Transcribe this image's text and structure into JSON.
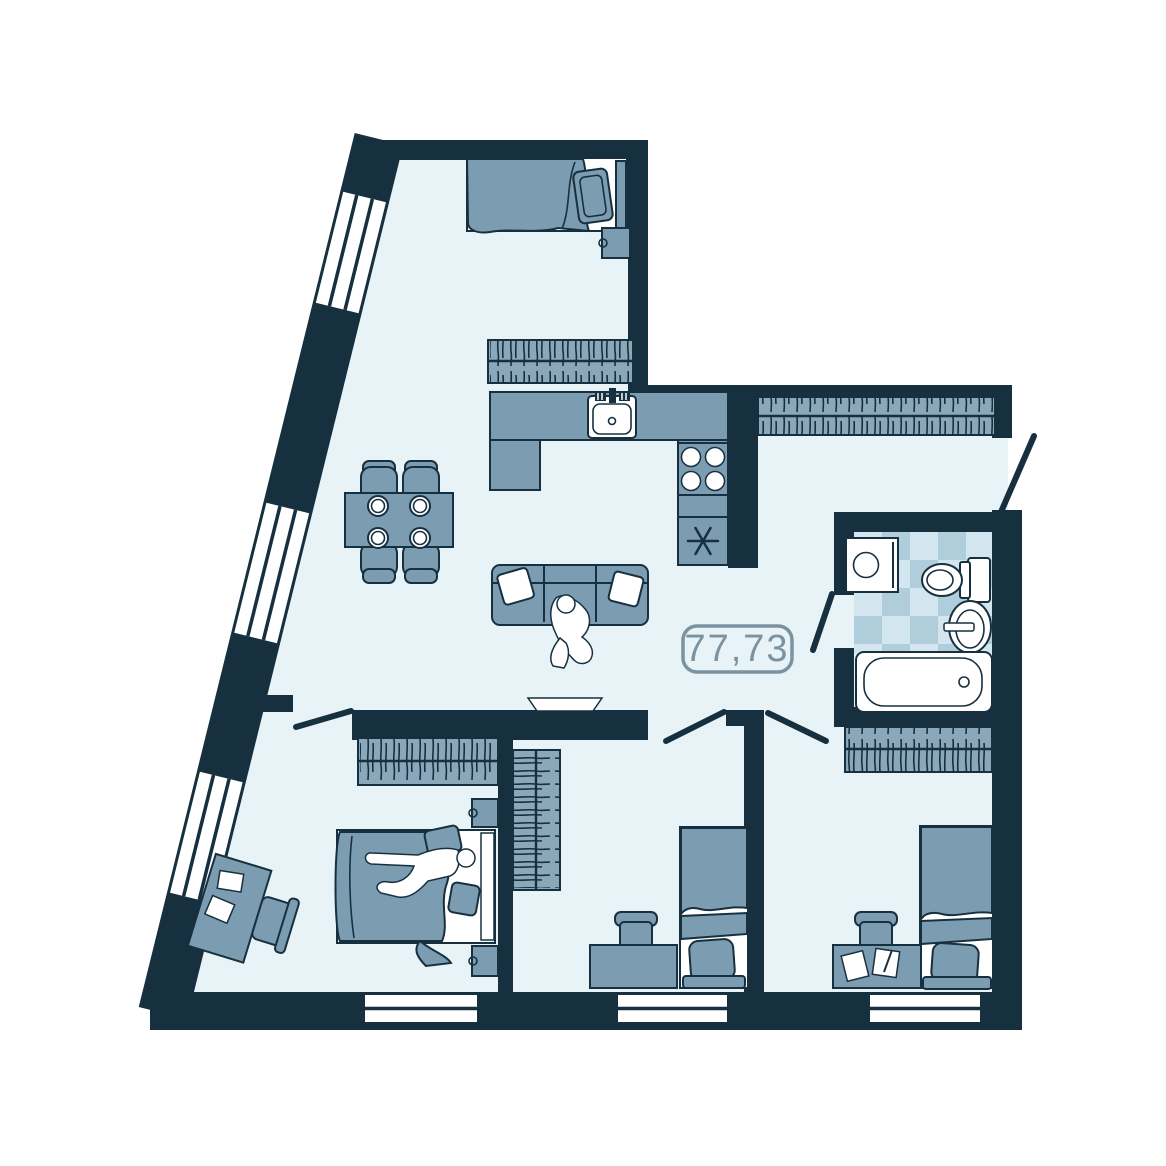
{
  "area_badge": {
    "text": "77,73"
  },
  "colors": {
    "wall": "#17303f",
    "floor": "#e8f3f8",
    "furniture": "#7c9cb2",
    "furniture_light": "#8ba7ba",
    "tile_a": "#d3e5ee",
    "tile_b": "#b0cddc",
    "badge": "#7b93a0",
    "outside": "#ffffff"
  },
  "furniture_icons": [
    "double-bed",
    "single-bed",
    "wardrobe",
    "closet",
    "dining-table",
    "chair",
    "plate",
    "sofa",
    "pillow",
    "person",
    "tv",
    "desk",
    "papers",
    "kitchen-counter",
    "kitchen-sink",
    "stove",
    "fridge",
    "washing-machine",
    "toilet",
    "bathroom-sink",
    "bathtub",
    "door-leaf",
    "window"
  ]
}
